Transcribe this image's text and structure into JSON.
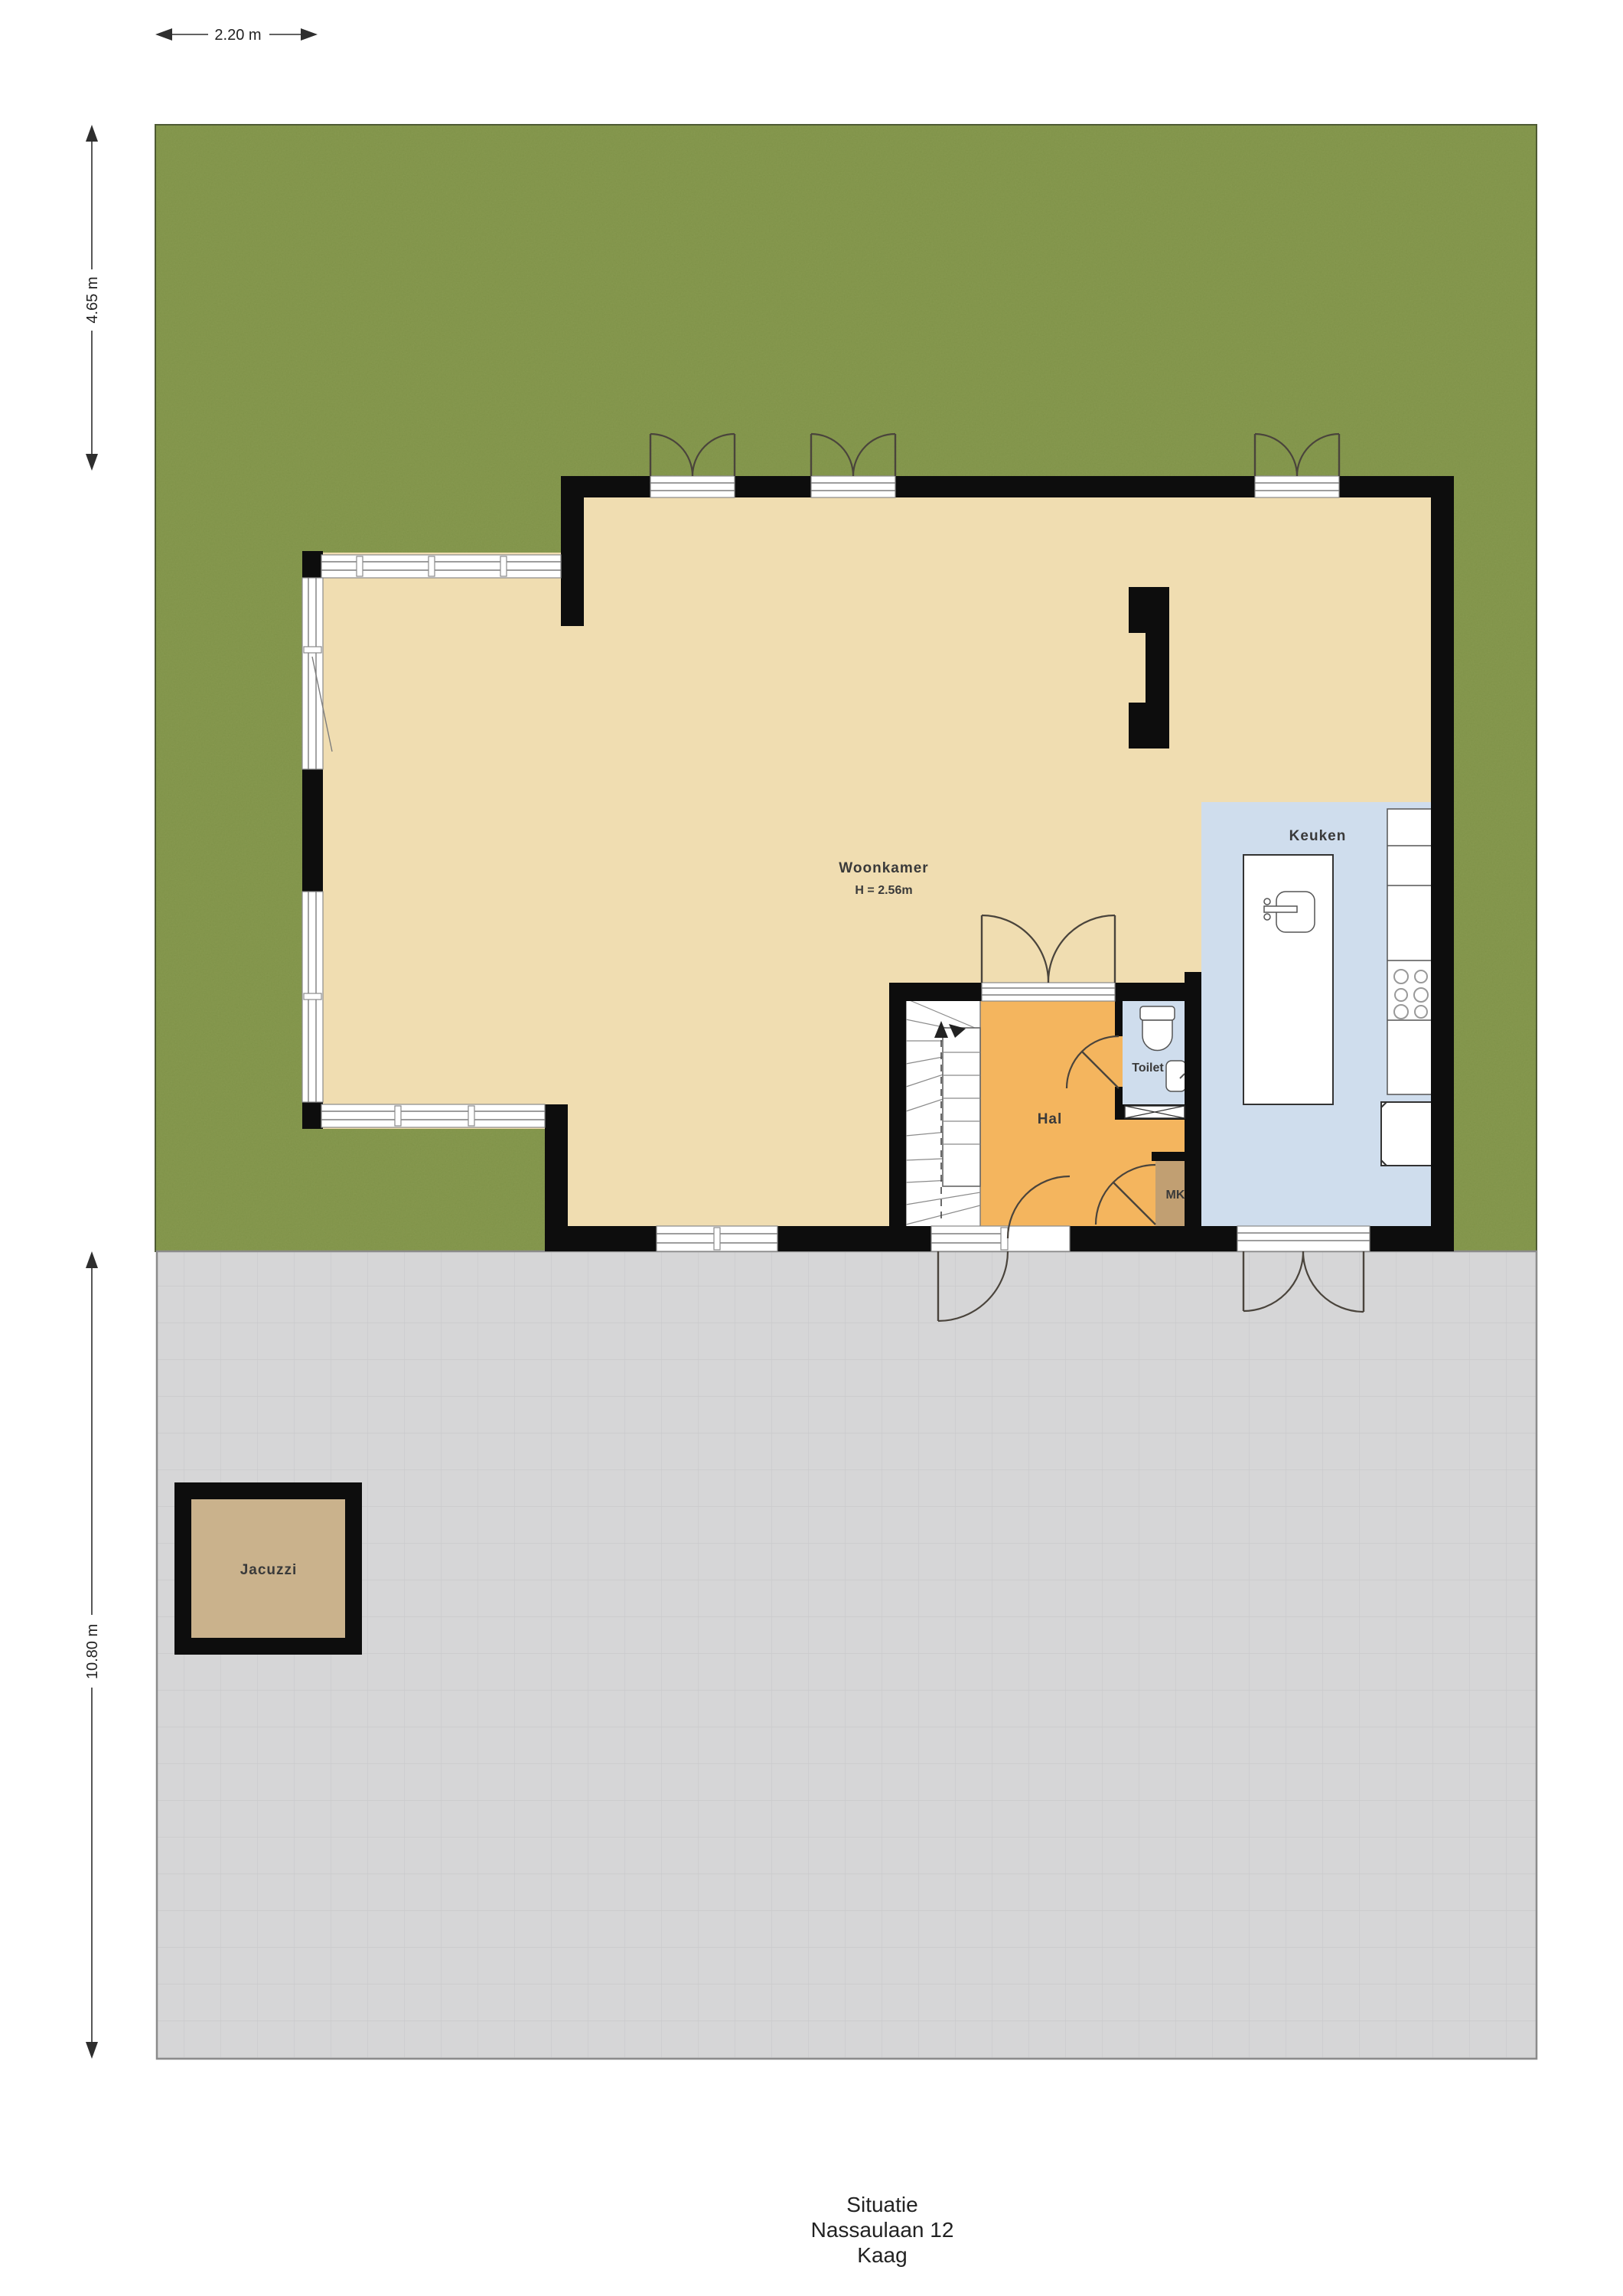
{
  "caption": {
    "line1": "Situatie",
    "line2": "Nassaulaan 12",
    "line3": "Kaag"
  },
  "dimensions": {
    "garden_width": "2.20 m",
    "garden_depth": "4.65 m",
    "terrace_depth": "10.80 m"
  },
  "rooms": {
    "living": {
      "name": "Woonkamer",
      "ceiling_height": "H = 2.56m"
    },
    "kitchen": {
      "name": "Keuken"
    },
    "hall": {
      "name": "Hal"
    },
    "toilet": {
      "name": "Toilet"
    },
    "meter_closet": {
      "name": "MK"
    },
    "jacuzzi": {
      "name": "Jacuzzi"
    }
  },
  "colors": {
    "grass": "#7e9147",
    "terrace": "#d6d6d7",
    "terrace_line": "#c7c7c9",
    "floor_living": "#f0ddb1",
    "floor_hall": "#f4b55e",
    "floor_wet": "#cfdded",
    "floor_mk": "#c19f72",
    "jacuzzi": "#cab28c",
    "wall": "#0d0d0d",
    "line": "#4a443c"
  }
}
